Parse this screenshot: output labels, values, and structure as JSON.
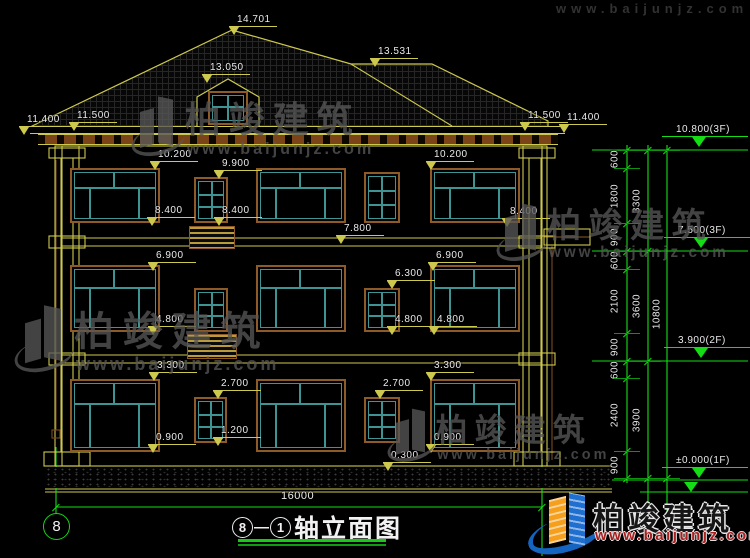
{
  "colors": {
    "yellow": "#cdc84e",
    "brown": "#8e5a28",
    "pipe": "#7a4a22",
    "teal": "#3f9393",
    "green": "#15dd15",
    "white": "#e9e9e9",
    "gray": "#575757",
    "red": "#aa1f1f",
    "blue": "#1565c0",
    "orange": "#f59f1d",
    "background": "#000000"
  },
  "title": {
    "axis_start": "8",
    "separator": "—",
    "axis_end": "1",
    "name": "轴立面图"
  },
  "axis_bubble": {
    "label": "8"
  },
  "bottom_dim": {
    "label": "16000",
    "x1": 56,
    "x2": 542,
    "y": 507,
    "tx": 281,
    "ty": 490
  },
  "markers_building": [
    {
      "t": "14.701",
      "x": 237,
      "y": 14
    },
    {
      "t": "13.531",
      "x": 378,
      "y": 46
    },
    {
      "t": "13.050",
      "x": 210,
      "y": 62
    },
    {
      "t": "11.400",
      "x": 27,
      "y": 114
    },
    {
      "t": "11.500",
      "x": 77,
      "y": 110
    },
    {
      "t": "11.500",
      "x": 528,
      "y": 110
    },
    {
      "t": "11.400",
      "x": 567,
      "y": 112
    },
    {
      "t": "10.200",
      "x": 158,
      "y": 149
    },
    {
      "t": "9.900",
      "x": 222,
      "y": 158
    },
    {
      "t": "10.200",
      "x": 434,
      "y": 149
    },
    {
      "t": "8.400",
      "x": 155,
      "y": 205
    },
    {
      "t": "8.400",
      "x": 222,
      "y": 205
    },
    {
      "t": "8.400",
      "x": 510,
      "y": 206
    },
    {
      "t": "7.800",
      "x": 344,
      "y": 223
    },
    {
      "t": "6.900",
      "x": 156,
      "y": 250
    },
    {
      "t": "6.900",
      "x": 436,
      "y": 250
    },
    {
      "t": "6.300",
      "x": 395,
      "y": 268
    },
    {
      "t": "4.800",
      "x": 156,
      "y": 314
    },
    {
      "t": "4.800",
      "x": 395,
      "y": 314
    },
    {
      "t": "4.800",
      "x": 437,
      "y": 314
    },
    {
      "t": "3.300",
      "x": 157,
      "y": 360
    },
    {
      "t": "3.300",
      "x": 434,
      "y": 360
    },
    {
      "t": "2.700",
      "x": 221,
      "y": 378
    },
    {
      "t": "2.700",
      "x": 383,
      "y": 378
    },
    {
      "t": "1.200",
      "x": 221,
      "y": 425
    },
    {
      "t": "0.900",
      "x": 156,
      "y": 432
    },
    {
      "t": "0.900",
      "x": 434,
      "y": 432
    },
    {
      "t": "0.300",
      "x": 391,
      "y": 450
    }
  ],
  "markers_levels": [
    {
      "t": "10.800(3F)",
      "x": 676,
      "y": 124,
      "ly": 150
    },
    {
      "t": "7.500(3F)",
      "x": 678,
      "y": 225,
      "ly": 251
    },
    {
      "t": "3.900(2F)",
      "x": 678,
      "y": 335,
      "ly": 361
    },
    {
      "t": "±0.000(1F)",
      "x": 676,
      "y": 455,
      "ly": 480
    }
  ],
  "dim_chains": [
    {
      "x": 627,
      "label_x": 615,
      "boundaries": [
        150,
        168,
        223,
        251,
        269,
        333,
        361,
        378,
        451,
        478
      ],
      "labels": [
        "600",
        "1800",
        "900",
        "600",
        "2100",
        "900",
        "600",
        "2400",
        "900"
      ]
    },
    {
      "x": 648,
      "label_x": 637,
      "boundaries": [
        150,
        251,
        361,
        478
      ],
      "labels": [
        "3300",
        "3600",
        "3900"
      ]
    },
    {
      "x": 667,
      "label_x": 657,
      "boundaries": [
        150,
        478
      ],
      "labels": [
        "10800"
      ]
    }
  ],
  "windows": [
    {
      "x": 70,
      "y": 168,
      "w": 90,
      "h": 55,
      "type": "big"
    },
    {
      "x": 194,
      "y": 177,
      "w": 34,
      "h": 46,
      "type": "small"
    },
    {
      "x": 256,
      "y": 168,
      "w": 90,
      "h": 55,
      "type": "big"
    },
    {
      "x": 364,
      "y": 172,
      "w": 36,
      "h": 51,
      "type": "small"
    },
    {
      "x": 430,
      "y": 168,
      "w": 90,
      "h": 55,
      "type": "big"
    },
    {
      "x": 70,
      "y": 265,
      "w": 90,
      "h": 67,
      "type": "big"
    },
    {
      "x": 194,
      "y": 288,
      "w": 34,
      "h": 44,
      "type": "small"
    },
    {
      "x": 256,
      "y": 265,
      "w": 90,
      "h": 67,
      "type": "big"
    },
    {
      "x": 364,
      "y": 288,
      "w": 36,
      "h": 44,
      "type": "small"
    },
    {
      "x": 430,
      "y": 265,
      "w": 90,
      "h": 67,
      "type": "big"
    },
    {
      "x": 70,
      "y": 379,
      "w": 90,
      "h": 73,
      "type": "big"
    },
    {
      "x": 194,
      "y": 397,
      "w": 33,
      "h": 46,
      "type": "small"
    },
    {
      "x": 256,
      "y": 379,
      "w": 90,
      "h": 73,
      "type": "big"
    },
    {
      "x": 364,
      "y": 397,
      "w": 36,
      "h": 46,
      "type": "small"
    },
    {
      "x": 430,
      "y": 379,
      "w": 90,
      "h": 73,
      "type": "big"
    },
    {
      "x": 208,
      "y": 91,
      "w": 40,
      "h": 34,
      "type": "dormer"
    }
  ],
  "balcony_panels": [
    {
      "x": 189,
      "y": 226,
      "w": 46,
      "h": 23
    },
    {
      "x": 187,
      "y": 334,
      "w": 50,
      "h": 25
    }
  ],
  "watermarks": [
    {
      "x": 138,
      "y": 96,
      "s": 36,
      "text": "柏竣建筑",
      "url": "www.baijunjz.com"
    },
    {
      "x": 503,
      "y": 203,
      "s": 34,
      "text": "柏竣建筑",
      "url": "www.baijunjz.com"
    },
    {
      "x": 22,
      "y": 305,
      "s": 40,
      "text": "柏竣建筑",
      "url": "www.baijunjz.com"
    },
    {
      "x": 394,
      "y": 408,
      "s": 32,
      "text": "柏竣建筑",
      "url": "www.baijunjz.com"
    }
  ],
  "watermark_top_partial": {
    "x": 556,
    "y": 1,
    "url": "www.baijunjz.com"
  },
  "logo": {
    "text": "柏竣建筑",
    "url": "www.baijunjz.com"
  },
  "svg": {
    "polys": [
      {
        "pts": "30,127 232,30 351,64 432,64 548,121 548,127",
        "stroke": "yellow",
        "fill": "none"
      },
      {
        "pts": "197,97 228,79 259,97 259,127 197,127",
        "stroke": "yellow",
        "fill": "#000000"
      }
    ],
    "lines": [
      {
        "p": [
          351,
          64,
          452,
          126
        ],
        "c": "yellow"
      },
      {
        "p": [
          62,
          146,
          542,
          146
        ],
        "c": "yellow"
      },
      {
        "p": [
          62,
          238,
          542,
          238
        ],
        "c": "yellow"
      },
      {
        "p": [
          62,
          246,
          542,
          246
        ],
        "c": "yellow"
      },
      {
        "p": [
          62,
          355,
          542,
          355
        ],
        "c": "yellow"
      },
      {
        "p": [
          62,
          363,
          542,
          363
        ],
        "c": "yellow"
      },
      {
        "p": [
          45,
          466,
          612,
          466
        ],
        "c": "yellow"
      },
      {
        "p": [
          45,
          489,
          612,
          489
        ],
        "c": "yellow"
      },
      {
        "p": [
          45,
          492,
          612,
          492
        ],
        "c": "yellow"
      },
      {
        "p": [
          61,
          158,
          61,
          452
        ],
        "c": "yellow"
      },
      {
        "p": [
          73,
          158,
          73,
          452
        ],
        "c": "yellow"
      },
      {
        "p": [
          529,
          158,
          529,
          452
        ],
        "c": "yellow"
      },
      {
        "p": [
          541,
          158,
          541,
          452
        ],
        "c": "yellow"
      },
      {
        "p": [
          544,
          237,
          590,
          237
        ],
        "c": "brown"
      },
      {
        "p": [
          56,
          160,
          56,
          430
        ],
        "c": "pipe"
      },
      {
        "p": [
          552,
          246,
          552,
          460
        ],
        "c": "pipe"
      },
      {
        "p": [
          592,
          150,
          748,
          150
        ],
        "c": "green"
      },
      {
        "p": [
          592,
          251,
          748,
          251
        ],
        "c": "green"
      },
      {
        "p": [
          592,
          361,
          748,
          361
        ],
        "c": "green"
      },
      {
        "p": [
          592,
          480,
          748,
          480
        ],
        "c": "green"
      },
      {
        "p": [
          640,
          492,
          748,
          492
        ],
        "c": "green"
      },
      {
        "p": [
          627,
          145,
          627,
          483
        ],
        "c": "green"
      },
      {
        "p": [
          648,
          145,
          648,
          533
        ],
        "c": "green"
      },
      {
        "p": [
          667,
          145,
          667,
          533
        ],
        "c": "green"
      },
      {
        "p": [
          56,
          447,
          56,
          513
        ],
        "c": "green"
      },
      {
        "p": [
          56,
          507,
          542,
          507
        ],
        "c": "green"
      },
      {
        "p": [
          542,
          452,
          542,
          556
        ],
        "c": "green"
      }
    ],
    "rects": [
      {
        "r": [
          62,
          146,
          480,
          320
        ],
        "c": "yellow"
      },
      {
        "r": [
          55,
          146,
          24,
          320
        ],
        "c": "yellow"
      },
      {
        "r": [
          523,
          146,
          24,
          320
        ],
        "c": "yellow"
      },
      {
        "r": [
          49,
          148,
          36,
          10
        ],
        "c": "yellow"
      },
      {
        "r": [
          49,
          236,
          36,
          12
        ],
        "c": "yellow"
      },
      {
        "r": [
          49,
          353,
          36,
          12
        ],
        "c": "yellow"
      },
      {
        "r": [
          44,
          452,
          46,
          14
        ],
        "c": "yellow"
      },
      {
        "r": [
          519,
          148,
          36,
          10
        ],
        "c": "yellow"
      },
      {
        "r": [
          519,
          236,
          36,
          12
        ],
        "c": "yellow"
      },
      {
        "r": [
          519,
          353,
          36,
          12
        ],
        "c": "yellow"
      },
      {
        "r": [
          514,
          452,
          46,
          14
        ],
        "c": "yellow"
      },
      {
        "r": [
          544,
          229,
          46,
          16
        ],
        "c": "yellow"
      },
      {
        "r": [
          52,
          430,
          8,
          8
        ],
        "c": "pipe"
      }
    ]
  }
}
